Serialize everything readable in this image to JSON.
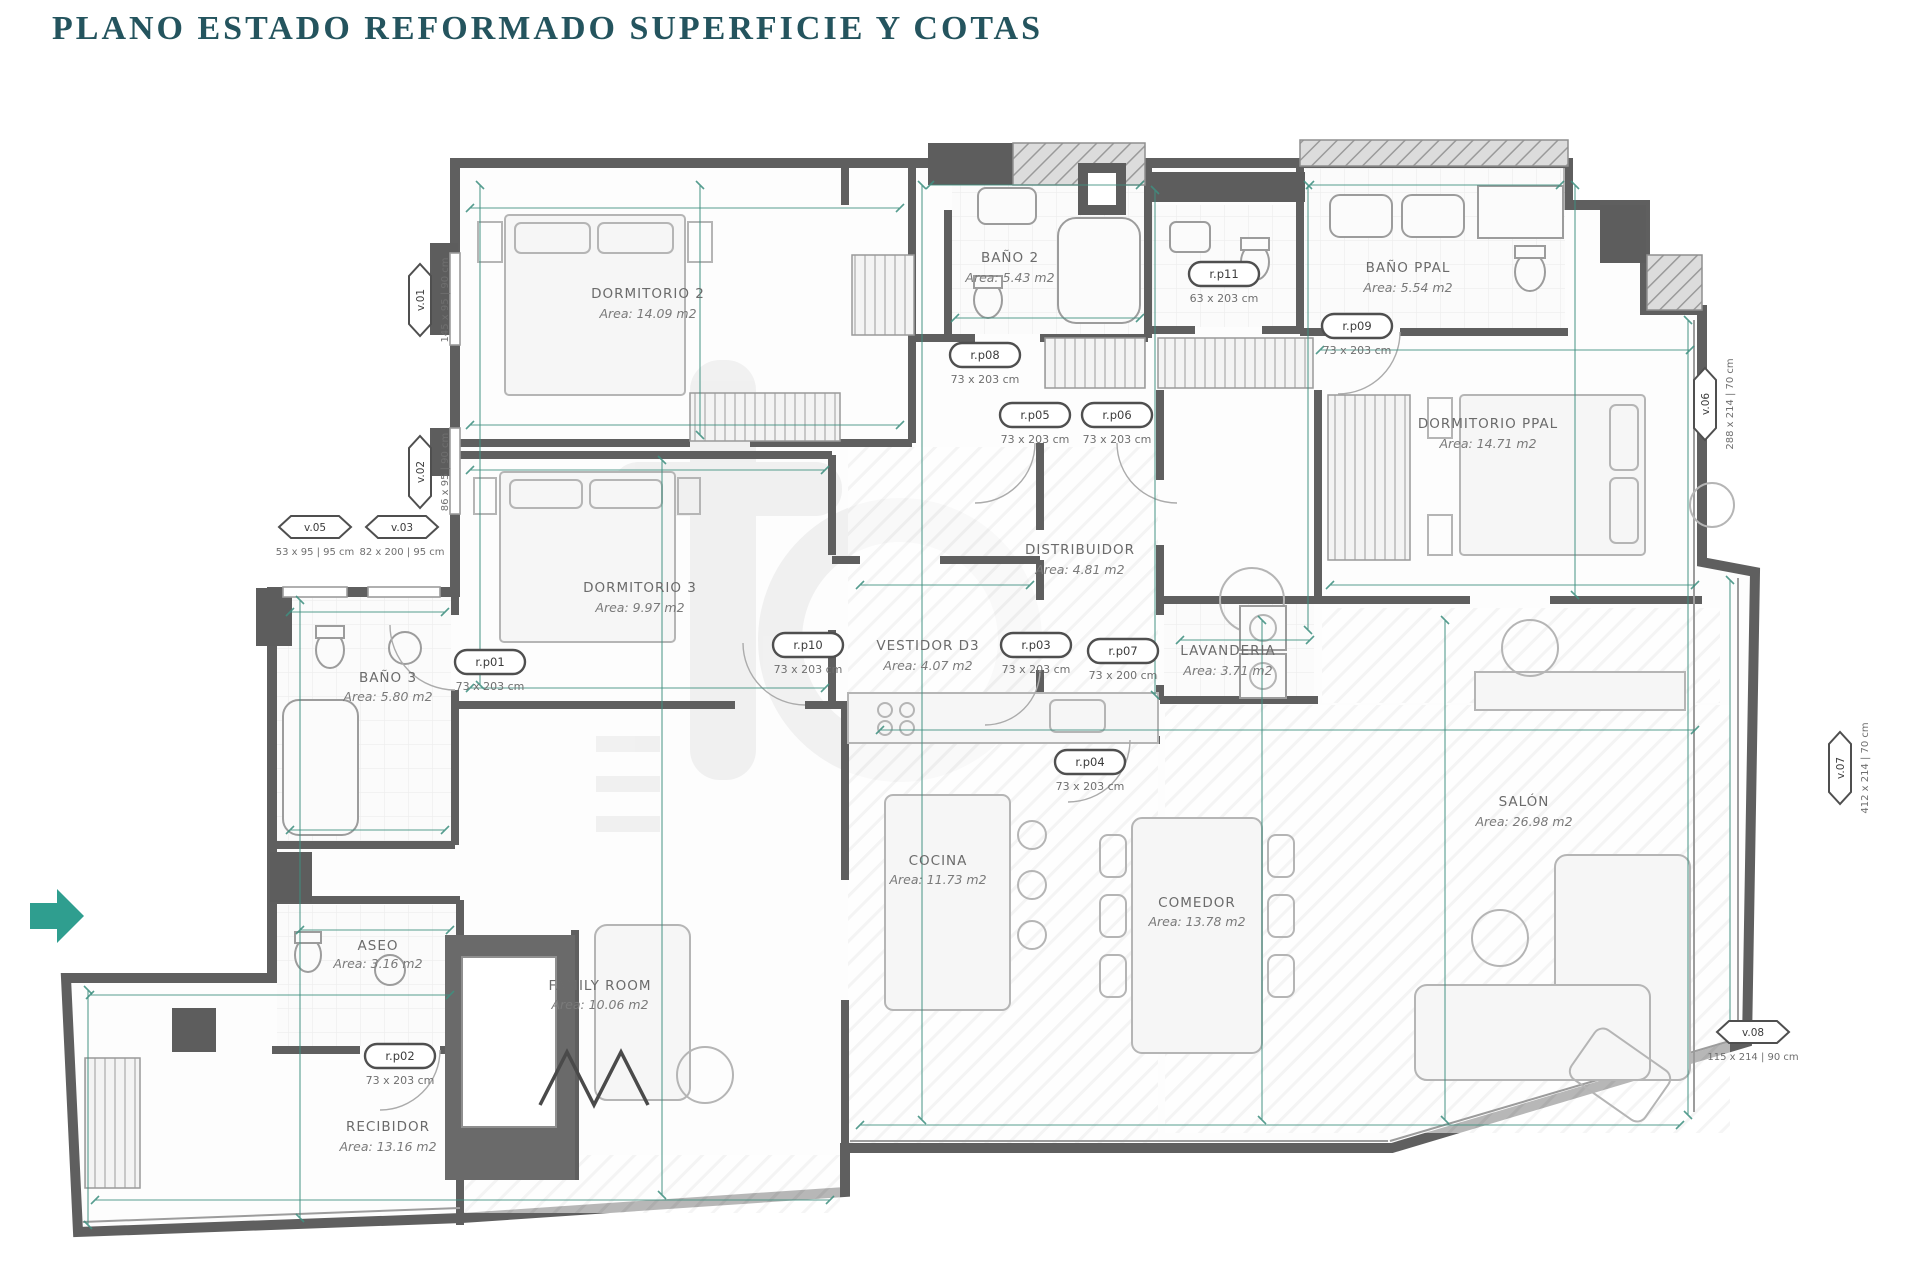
{
  "title": "PLANO ESTADO REFORMADO SUPERFICIE Y COTAS",
  "colors": {
    "title_teal": "#24545e",
    "dimension_teal": "#3f9080",
    "wall_gray": "#5f5f5f",
    "label_gray": "#6b6b6b",
    "entry_arrow_teal": "#2f9e8f"
  },
  "rooms": [
    {
      "name": "DORMITORIO 2",
      "area": "Area: 14.09 m2"
    },
    {
      "name": "BAÑO 2",
      "area": "Area: 5.43 m2"
    },
    {
      "name": "BAÑO PPAL",
      "area": "Area: 5.54 m2"
    },
    {
      "name": "DORMITORIO PPAL",
      "area": "Area: 14.71 m2"
    },
    {
      "name": "DORMITORIO 3",
      "area": "Area: 9.97 m2"
    },
    {
      "name": "DISTRIBUIDOR",
      "area": "Area: 4.81 m2"
    },
    {
      "name": "VESTIDOR D3",
      "area": "Area: 4.07 m2"
    },
    {
      "name": "LAVANDERIA",
      "area": "Area: 3.71 m2"
    },
    {
      "name": "BAÑO 3",
      "area": "Area: 5.80 m2"
    },
    {
      "name": "ASEO",
      "area": "Area: 3.16 m2"
    },
    {
      "name": "FAMILY ROOM",
      "area": "Area: 10.06 m2"
    },
    {
      "name": "COCINA",
      "area": "Area: 11.73 m2"
    },
    {
      "name": "COMEDOR",
      "area": "Area: 13.78 m2"
    },
    {
      "name": "SALÓN",
      "area": "Area: 26.98 m2"
    },
    {
      "name": "RECIBIDOR",
      "area": "Area: 13.16 m2"
    }
  ],
  "door_tags": [
    {
      "id": "r.p08",
      "size": "73 x 203 cm"
    },
    {
      "id": "r.p05",
      "size": "73 x 203 cm"
    },
    {
      "id": "r.p06",
      "size": "73 x 203 cm"
    },
    {
      "id": "r.p11",
      "size": "63 x 203 cm"
    },
    {
      "id": "r.p09",
      "size": "73 x 203 cm"
    },
    {
      "id": "r.p10",
      "size": "73 x 203 cm"
    },
    {
      "id": "r.p03",
      "size": "73 x 203 cm"
    },
    {
      "id": "r.p07",
      "size": "73 x 200 cm"
    },
    {
      "id": "r.p04",
      "size": "73 x 203 cm"
    },
    {
      "id": "r.p01",
      "size": "73 x 203 cm"
    },
    {
      "id": "r.p02",
      "size": "73 x 203 cm"
    }
  ],
  "window_tags": [
    {
      "id": "v.01",
      "size": "145 x 95 | 90 cm"
    },
    {
      "id": "v.02",
      "size": "86 x 95 | 90 cm"
    },
    {
      "id": "v.05",
      "size": "53 x 95 | 95 cm"
    },
    {
      "id": "v.03",
      "size": "82 x 200 | 95 cm"
    },
    {
      "id": "v.06",
      "size": "288 x 214 | 70 cm"
    },
    {
      "id": "v.07",
      "size": "412 x 214 | 70 cm"
    },
    {
      "id": "v.08",
      "size": "115 x 214 | 90 cm"
    }
  ]
}
